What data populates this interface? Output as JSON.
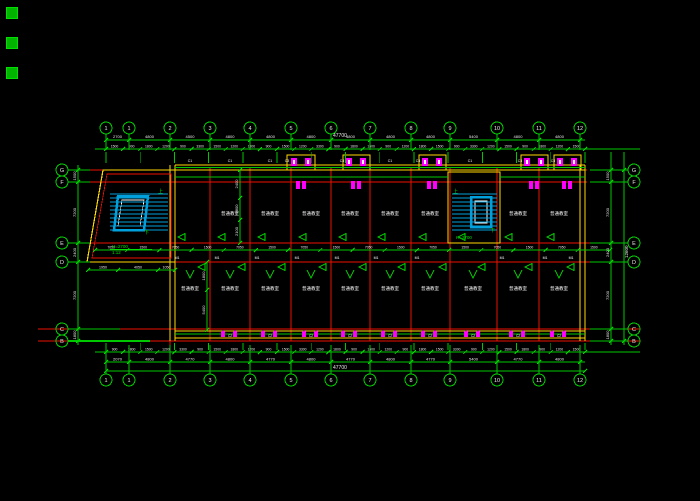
{
  "drawing": {
    "axes": {
      "top": [
        "1",
        "1",
        "2",
        "3",
        "4",
        "5",
        "6",
        "7",
        "8",
        "9",
        "10",
        "11",
        "12"
      ],
      "bottom": [
        "1",
        "1",
        "2",
        "3",
        "4",
        "5",
        "6",
        "7",
        "8",
        "9",
        "10",
        "11",
        "12"
      ],
      "left": [
        "G",
        "F",
        "E",
        "D",
        "C",
        "B"
      ],
      "right": [
        "G",
        "F",
        "E",
        "D",
        "C",
        "B"
      ]
    },
    "dims": {
      "top_row1": [
        "2700",
        "4800",
        "4500",
        "4800",
        "4800",
        "4800",
        "4800",
        "4800",
        "4800",
        "5400",
        "4800",
        "4800"
      ],
      "top_row2": [
        "1500",
        "900",
        "1800",
        "1200",
        "900",
        "3300",
        "1500",
        "1200",
        "1800",
        "900",
        "1500",
        "1200",
        "3300",
        "900",
        "1800",
        "1500",
        "900",
        "1200",
        "1800",
        "1500",
        "900",
        "3300",
        "1200",
        "1500",
        "900",
        "1800",
        "1200",
        "1500"
      ],
      "bottom_row1": [
        "900",
        "1800",
        "1500",
        "1200",
        "3300",
        "900",
        "1500",
        "1800",
        "1200",
        "900",
        "1500",
        "3300",
        "1200",
        "1800",
        "900",
        "1500",
        "1200",
        "900",
        "1800",
        "1500",
        "3300",
        "900",
        "1200",
        "1500",
        "1800",
        "900",
        "1200",
        "1500"
      ],
      "bottom_row2": [
        "2070",
        "4800",
        "4770",
        "4800",
        "4770",
        "4800",
        "4770",
        "4800",
        "4770",
        "5400",
        "4770",
        "4800"
      ],
      "corridor": [
        "7050",
        "1500",
        "7050",
        "1500",
        "7050",
        "1500",
        "7050",
        "1500",
        "7050",
        "1500",
        "7050",
        "1500",
        "7050",
        "1500",
        "7050",
        "1500"
      ],
      "left_col": [
        "1500",
        "7200",
        "2400",
        "7200",
        "1800"
      ],
      "right_col": [
        "1500",
        "7200",
        "2400",
        "7200",
        "1800"
      ],
      "interior_col": [
        "2400",
        "1800",
        "2100"
      ],
      "stair_row": [
        "1950",
        "4050",
        "1050"
      ],
      "side_col": [
        "1800",
        "5400"
      ]
    },
    "totals": {
      "top": "47700",
      "bottom": "47700",
      "right": "12600"
    },
    "rooms": {
      "top": [
        "普通教室",
        "普通教室",
        "普通教室",
        "普通教室",
        "普通教室",
        "普通教室",
        "普通教室",
        "普通教室"
      ],
      "bottom": [
        "普通教室",
        "普通教室",
        "普通教室",
        "普通教室",
        "普通教室",
        "普通教室",
        "普通教室",
        "普通教室",
        "普通教室",
        "普通教室"
      ]
    },
    "tags": {
      "door": "M1",
      "window_top": "C1",
      "window_bay": "C3",
      "window_bottom": "C2"
    },
    "notes": {
      "stair1": [
        "H=2700",
        "1:12"
      ],
      "stair2": "H=2700",
      "up": "上",
      "down": "下"
    },
    "swatches": [
      "layer-swatch-1",
      "layer-swatch-2",
      "layer-swatch-3"
    ],
    "colors": {
      "dim_green": "#00c800",
      "grid_red": "#ee1100",
      "wall_yellow": "#ffd700",
      "stair_cyan": "#00a0dc",
      "fixture_magenta": "#ff00ff",
      "text_white": "#e8e8e8"
    }
  }
}
